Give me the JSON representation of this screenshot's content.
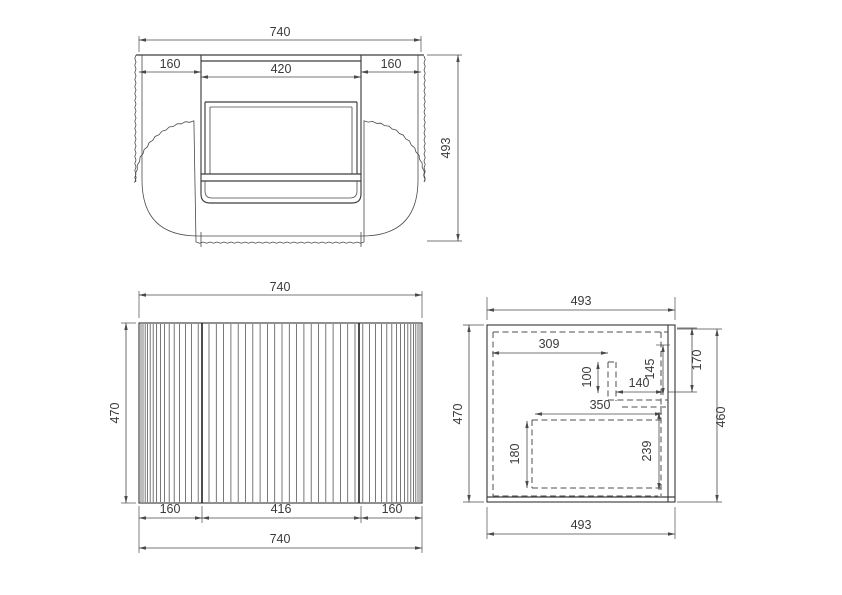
{
  "drawing": {
    "colors": {
      "background": "#ffffff",
      "line": "#3d3d3d",
      "dim_line": "#4a4a4a"
    },
    "views": {
      "top": {
        "dims": {
          "overall_width": "740",
          "left_section": "160",
          "opening_width": "420",
          "right_section": "160",
          "overall_depth": "493"
        }
      },
      "front": {
        "dims": {
          "overall_width": "740",
          "height": "470",
          "bottom_left": "160",
          "bottom_center": "416",
          "bottom_right": "160",
          "overall_width_bottom": "740"
        }
      },
      "side": {
        "dims": {
          "top_width": "493",
          "back_height": "470",
          "front_height": "460",
          "bottom_width": "493",
          "basin_offset": "309",
          "basin_back": "100",
          "gap_to_front": "140",
          "upper_recess": "145",
          "top_panel": "170",
          "drawer_depth": "350",
          "drawer_inner_height": "180",
          "lower_panel": "239"
        }
      }
    }
  }
}
